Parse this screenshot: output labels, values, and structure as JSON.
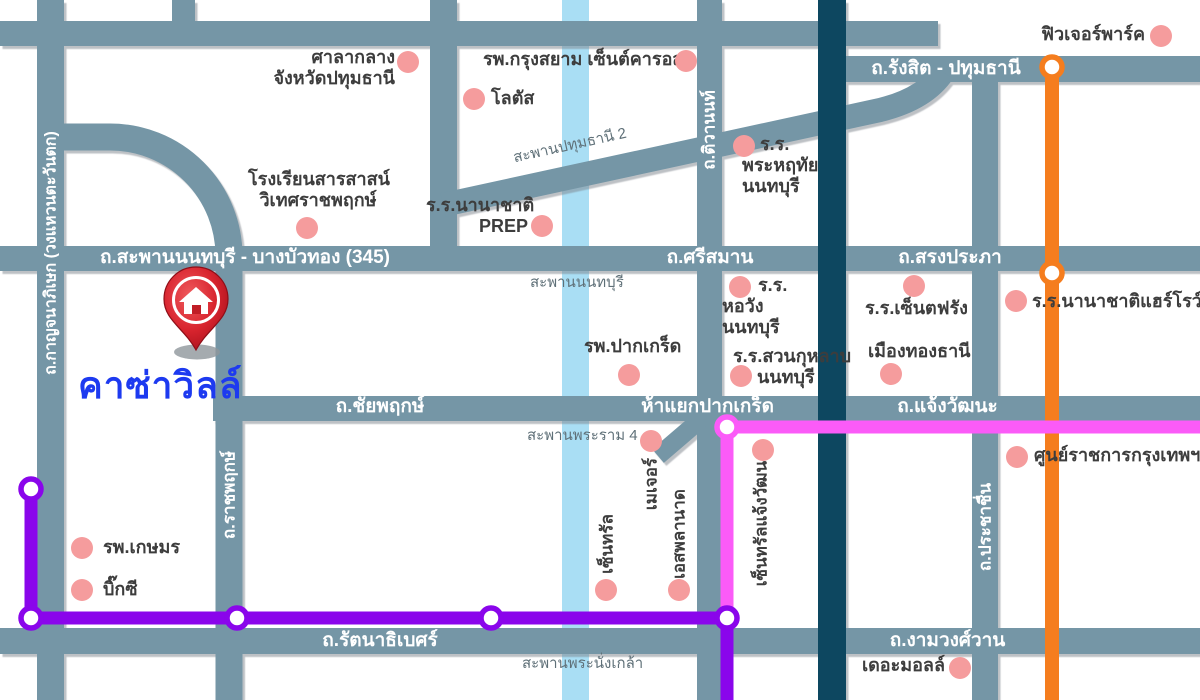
{
  "project": {
    "name": "คาซ่าวิลล์"
  },
  "colors": {
    "road": "#7496A6",
    "canal": "#A9DEF4",
    "navy": "#0F4660",
    "purple": "#8A05EB",
    "orange": "#F57D1E",
    "magenta": "#FB5BF8",
    "dot": "#F59C9D",
    "pin": "#C9202B",
    "brand": "#1D3AF0"
  },
  "roads": {
    "kanchanaphisek": "ถ.กาญจนาภิเษก (วงแหวนตะวันตก)",
    "saphan_nonthaburi_345": "ถ.สะพานนนทบุรี - บางบัวทอง (345)",
    "srisaman": "ถ.ศรีสมาน",
    "songprapha": "ถ.สรงประภา",
    "rangsit_pathumthani": "ถ.รังสิต - ปทุมธานี",
    "chaiyaphruek": "ถ.ชัยพฤกษ์",
    "ha_yaek_pakkret": "ห้าแยกปากเกร็ด",
    "chaengwatthana": "ถ.แจ้งวัฒนะ",
    "rattanathibet": "ถ.รัตนาธิเบศร์",
    "ngamwongwan": "ถ.งามวงศ์วาน",
    "ratchaphruek": "ถ.ราชพฤกษ์",
    "tiwanon": "ถ.ติวานนท์",
    "prachachuen": "ถ.ประชาชื่น"
  },
  "bridges": {
    "pathumthani2": "สะพานปทุมธานี 2",
    "nonthaburi": "สะพานนนทบุรี",
    "rama4": "สะพานพระราม 4",
    "phranangklao": "สะพานพระนั่งเกล้า"
  },
  "places": {
    "city_hall": {
      "line1": "ศาลากลาง",
      "line2": "จังหวัดปทุมธานี"
    },
    "krungsiam": "รพ.กรุงสยาม เซ็นต์คารอส",
    "lotus": "โลตัส",
    "future_park": "ฟิวเจอร์พาร์ค",
    "sarasas": {
      "line1": "โรงเรียนสารสาสน์",
      "line2": "วิเทศราชพฤกษ์"
    },
    "prep": {
      "line1": "ร.ร.นานาชาติ",
      "line2": "PREP"
    },
    "phraharuthai": {
      "line1": "ร.ร.",
      "line2": "พระหฤทัย",
      "line3": "นนทบุรี"
    },
    "horwang": {
      "line1": "ร.ร.",
      "line2": "หอวัง",
      "line3": "นนทบุรี"
    },
    "pakkret_hospital": "รพ.ปากเกร็ด",
    "suankularb": {
      "line1": "ร.ร.สวนกุหลาบ",
      "line2": "นนทบุรี"
    },
    "stfrancis": "ร.ร.เซ็นตฟรัง",
    "muangthong": "เมืองทองธานี",
    "harrow": "ร.ร.นานาชาติแฮร์โรว์",
    "govt_center": "ศูนย์ราชการกรุงเทพฯ",
    "kasem": "รพ.เกษมร",
    "bigc": "บิ๊กซี",
    "central": "เซ็นทรัล",
    "major": "เมเจอร์",
    "esplanade": "เอสพลานาด",
    "central_chaengwatthana": "เซ็นทรัลแจ้งวัฒนะ",
    "the_mall": "เดอะมอลล์"
  }
}
